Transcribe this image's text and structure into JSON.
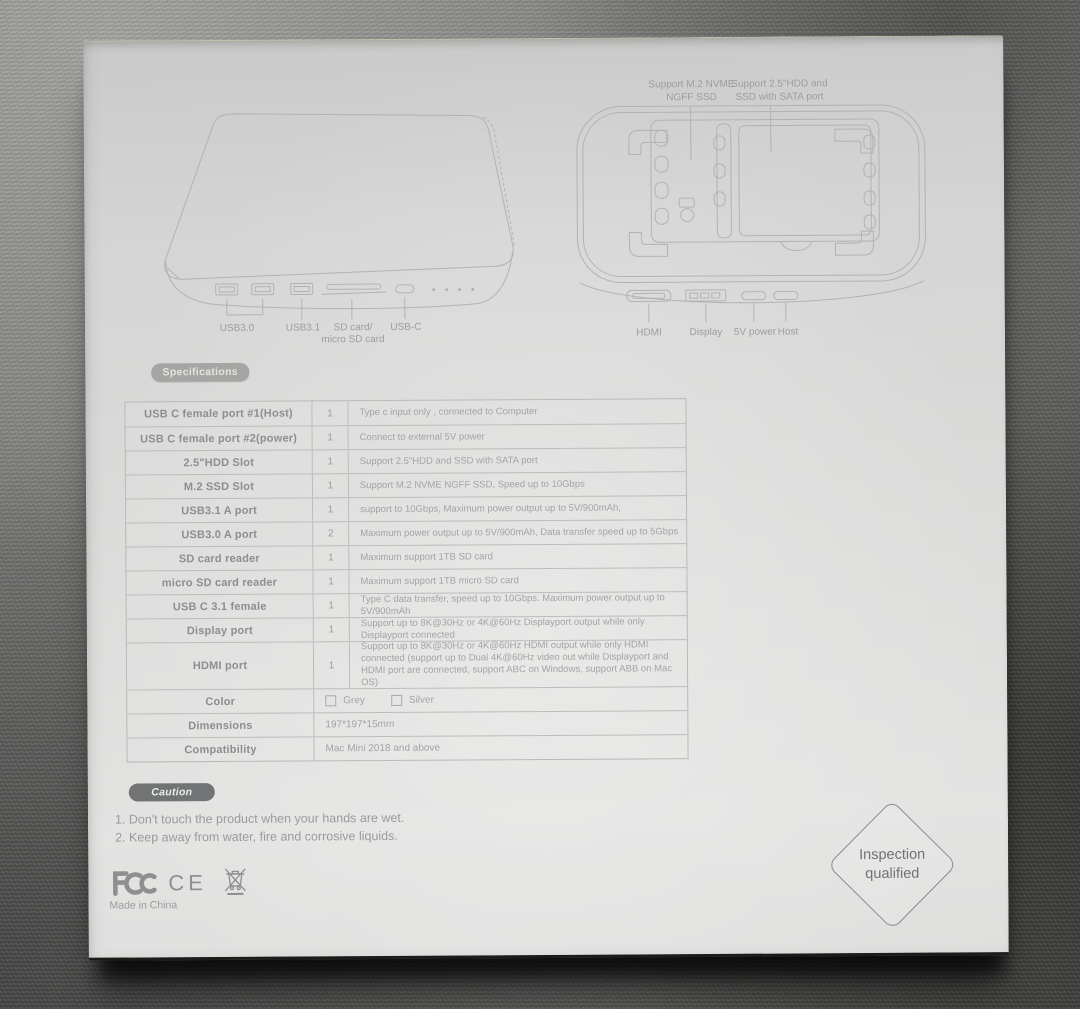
{
  "diagrams": {
    "front_view": {
      "port_labels": [
        "USB3.0",
        "USB3.1",
        "SD card/ micro SD card",
        "USB-C"
      ]
    },
    "bottom_view": {
      "callouts": [
        "Support M.2 NVME\nNGFF SSD",
        "Support 2.5\"HDD and\nSSD with SATA port"
      ],
      "port_labels": [
        "HDMI",
        "Display",
        "5V power",
        "Host"
      ]
    }
  },
  "specifications": {
    "badge": "Specifications",
    "rows": [
      {
        "label": "USB C female port #1(Host)",
        "qty": "1",
        "desc": "Type c input only , connected to Computer"
      },
      {
        "label": "USB C female port #2(power)",
        "qty": "1",
        "desc": "Connect to external 5V power"
      },
      {
        "label": "2.5\"HDD Slot",
        "qty": "1",
        "desc": "Support 2.5\"HDD and SSD with SATA port"
      },
      {
        "label": "M.2 SSD Slot",
        "qty": "1",
        "desc": "Support M.2 NVME NGFF SSD, Speed up to 10Gbps"
      },
      {
        "label": "USB3.1 A port",
        "qty": "1",
        "desc": "support to 10Gbps, Maximum power output up to 5V/900mAh,"
      },
      {
        "label": "USB3.0 A port",
        "qty": "2",
        "desc": "Maximum power output up to 5V/900mAh, Data transfer speed up to 5Gbps"
      },
      {
        "label": "SD card reader",
        "qty": "1",
        "desc": "Maximum support 1TB SD card"
      },
      {
        "label": "micro SD card reader",
        "qty": "1",
        "desc": "Maximum support 1TB micro SD card"
      },
      {
        "label": "USB C 3.1 female",
        "qty": "1",
        "desc": "Type C data transfer, speed up to 10Gbps. Maximum power output up to 5V/900mAh"
      },
      {
        "label": "Display port",
        "qty": "1",
        "desc": "Support up to 8K@30Hz or 4K@60Hz Displayport output while only Displayport connected"
      },
      {
        "label": "HDMI port",
        "qty": "1",
        "desc": "Support up to 8K@30Hz or 4K@60Hz HDMI output while only HDMI connected (support up to Dual 4K@60Hz video out while Displayport and HDMI port are connected, support ABC on Windows, support ABB on Mac OS)"
      }
    ],
    "color": {
      "label": "Color",
      "options": [
        "Grey",
        "Silver"
      ]
    },
    "dimensions": {
      "label": "Dimensions",
      "value": "197*197*15mm"
    },
    "compatibility": {
      "label": "Compatibility",
      "value": "Mac Mini 2018 and above"
    }
  },
  "caution": {
    "badge": "Caution",
    "items": [
      "1. Don't touch the product when your hands are wet.",
      "2. Keep away from water, fire and corrosive liquids."
    ]
  },
  "footer": {
    "ce": "CE",
    "made_in": "Made in China"
  },
  "stamp": {
    "text": "Inspection\nqualified"
  }
}
